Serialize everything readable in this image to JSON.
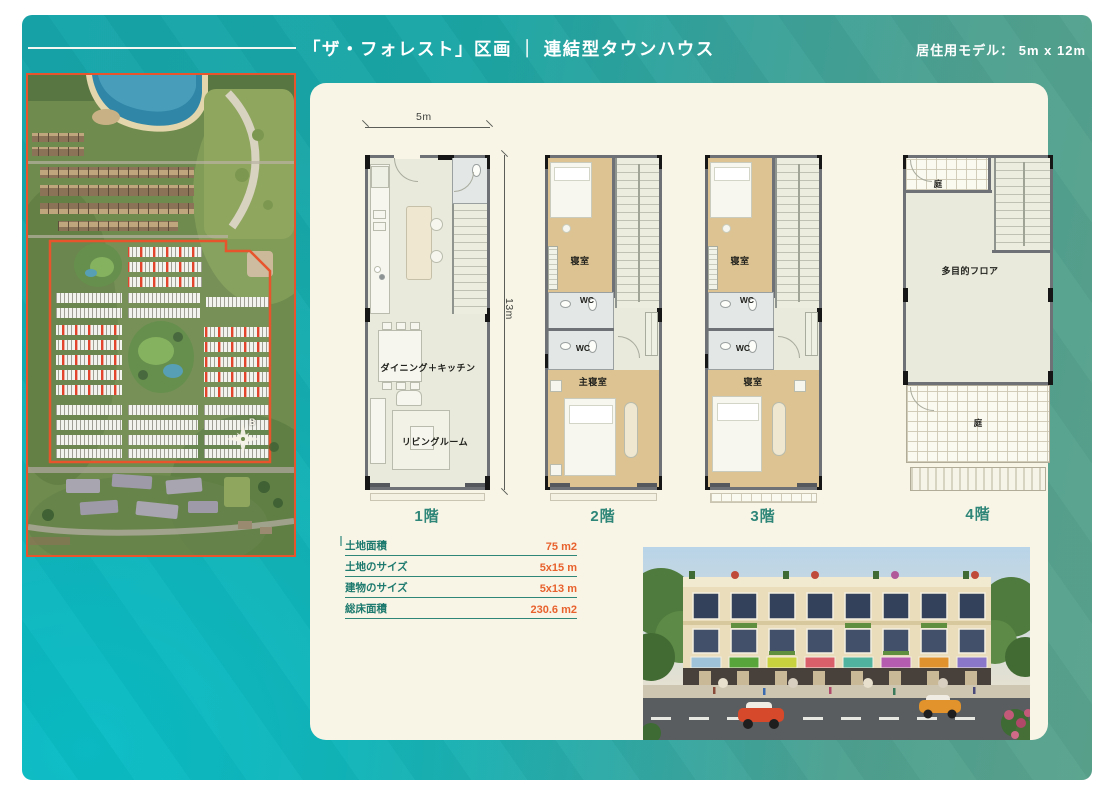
{
  "header": {
    "title": "「ザ・フォレスト」区画 ｜ 連結型タウンハウス",
    "model_label": "居住用モデル：  5m x 12m"
  },
  "site_map": {
    "compass_label": "B",
    "boundary_color": "#e8542c",
    "highlight_unit_color": "#e03a20",
    "lake_color": "#2f86a6"
  },
  "plans": [
    {
      "label": "1階",
      "dim_width": "5m",
      "dim_height": "13m",
      "rooms": {
        "dining": "ダイニング＋キッチン",
        "living": "リビングルーム"
      }
    },
    {
      "label": "2階",
      "rooms": {
        "bedroom": "寝室",
        "wc1": "WC",
        "wc2": "WC",
        "master": "主寝室"
      }
    },
    {
      "label": "3階",
      "rooms": {
        "bedroom": "寝室",
        "wc1": "WC",
        "wc2": "WC",
        "bedroom2": "寝室"
      }
    },
    {
      "label": "4階",
      "rooms": {
        "garden_top": "庭",
        "multipurpose": "多目的フロア",
        "garden_bottom": "庭"
      }
    }
  ],
  "spec_table": {
    "rows": [
      {
        "label": "土地面積",
        "value": "75 m2"
      },
      {
        "label": "土地のサイズ",
        "value": "5x15 m"
      },
      {
        "label": "建物のサイズ",
        "value": "5x13 m"
      },
      {
        "label": "総床面積",
        "value": "230.6 m2"
      }
    ]
  },
  "colors": {
    "background_teal": "#1ba6a5",
    "panel_cream": "#f8f4e6",
    "accent_teal": "#2e8678",
    "accent_orange": "#e8622d",
    "plan_floor": "#e9eadc",
    "plan_bedroom_tan": "#dcc391",
    "wall_gray": "#6e7277"
  },
  "render": {
    "sign_colors": [
      "#9fc3d8",
      "#57a53b",
      "#c8d23e",
      "#d95f6b",
      "#4fb3a0",
      "#b55cb0",
      "#e0922e",
      "#8b77c9"
    ],
    "car_left_color": "#d6492a",
    "car_right_color": "#e2932b"
  }
}
